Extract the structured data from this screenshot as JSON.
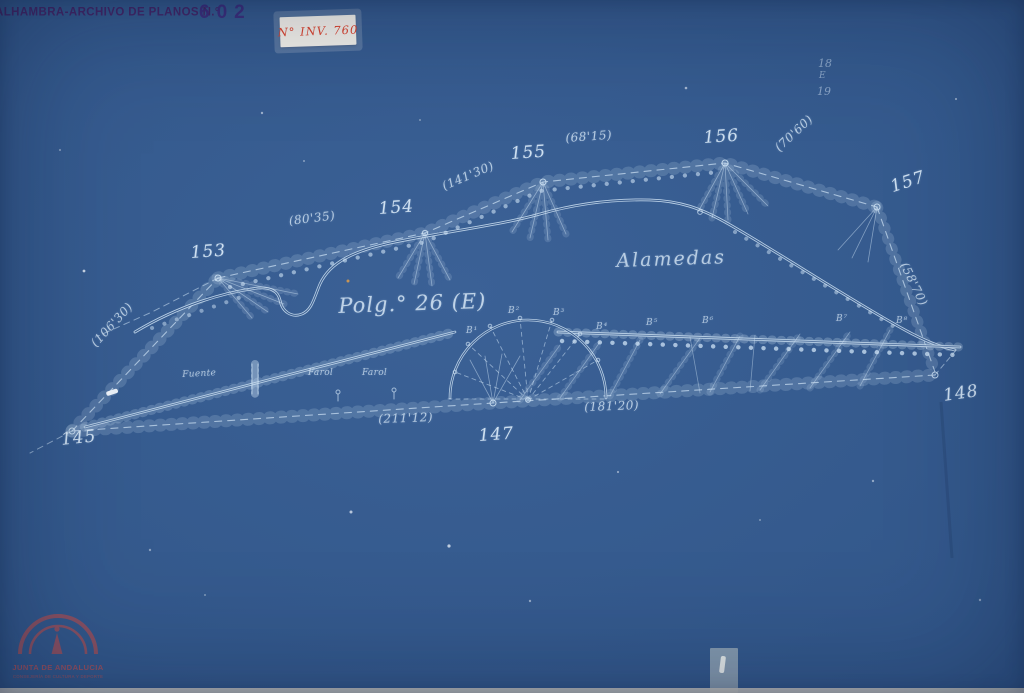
{
  "archive_header": {
    "stamp_text": "ALHAMBRA-ARCHIVO DE PLANOS N.°",
    "stamp_number": "602",
    "inventory_label": "N° INV. 760"
  },
  "corner_notes": {
    "top": "18",
    "middle": "E",
    "bottom": "19"
  },
  "plan": {
    "polygon_title": "Polg.° 26 (E)",
    "area_label": "Alamedas",
    "stations": {
      "s145": "145",
      "s147": "147",
      "s148": "148",
      "s153": "153",
      "s154": "154",
      "s155": "155",
      "s156": "156",
      "s157": "157"
    },
    "distances": {
      "d_145_153": "(106'30)",
      "d_153_154": "(80'35)",
      "d_154_155": "(141'30)",
      "d_155_156": "(68'15)",
      "d_156_157": "(70'60)",
      "d_157_148": "(58'70)",
      "d_145_147": "(211'12)",
      "d_147_148": "(181'20)"
    },
    "features": {
      "fountain": "Fuente",
      "lamp_1": "Farol",
      "lamp_2": "Farol"
    },
    "point_markers": {
      "b1": "B¹",
      "b2": "B²",
      "b3": "B³",
      "b4": "B⁴",
      "b5": "B⁵",
      "b6": "B⁶",
      "b7": "B⁷",
      "b8": "B⁸"
    }
  },
  "footer_stamp": {
    "org": "JUNTA DE ANDALUCIA",
    "dept": "CONSEJERÍA DE CULTURA Y DEPORTE"
  },
  "colors": {
    "paper_blue": "#33598C",
    "ink": "#CFE3F5",
    "stamp_purple": "#4C2A70",
    "sticker_red": "#E0452F",
    "logo_red": "#A34F5C"
  }
}
